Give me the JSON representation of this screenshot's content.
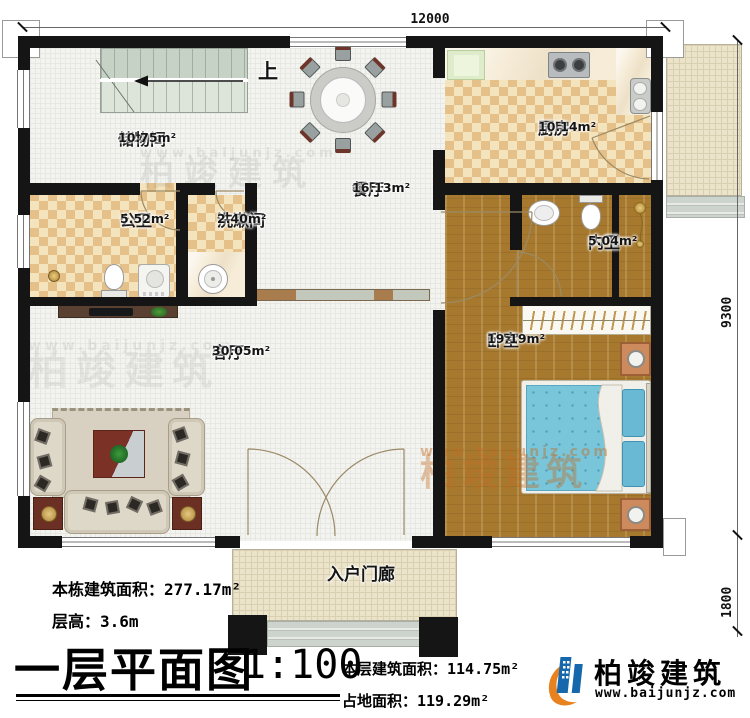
{
  "dimensions": {
    "top": "12000",
    "right_main": "9300",
    "right_porch": "1800"
  },
  "rooms": {
    "storage": {
      "name": "储物间",
      "area": "10.75m²"
    },
    "dining": {
      "name": "餐厅",
      "area": "16.13m²"
    },
    "kitchen": {
      "name": "厨房",
      "area": "10.14m²"
    },
    "public_bath": {
      "name": "公卫",
      "area": "5.52m²"
    },
    "washroom": {
      "name": "洗漱间",
      "area": "2.40m²"
    },
    "ensuite_bath": {
      "name": "内卫",
      "area": "5.04m²"
    },
    "bedroom": {
      "name": "卧室",
      "area": "19.19m²"
    },
    "living": {
      "name": "客厅",
      "area": "30.05m²"
    },
    "porch": {
      "name": "入户门廊"
    }
  },
  "stairs": {
    "up_label": "上"
  },
  "caption": {
    "title": "一层平面图",
    "scale": "1:100",
    "building_total_area": "本栋建筑面积：277.17m²",
    "floor_height": "层高：3.6m",
    "floor_area": "本层建筑面积：114.75m²",
    "footprint_area": "占地面积：119.29m²"
  },
  "brand": {
    "name": "柏竣建筑",
    "url": "www.baijunjz.com"
  },
  "colors": {
    "wall": "#151515",
    "checker_dark": "#e5c189",
    "checker_light": "#f4e4bd",
    "wood": "#a6792f",
    "bed_blue": "#79c5da",
    "brand_blue": "#1668ad",
    "brand_orange": "#e8821e"
  }
}
